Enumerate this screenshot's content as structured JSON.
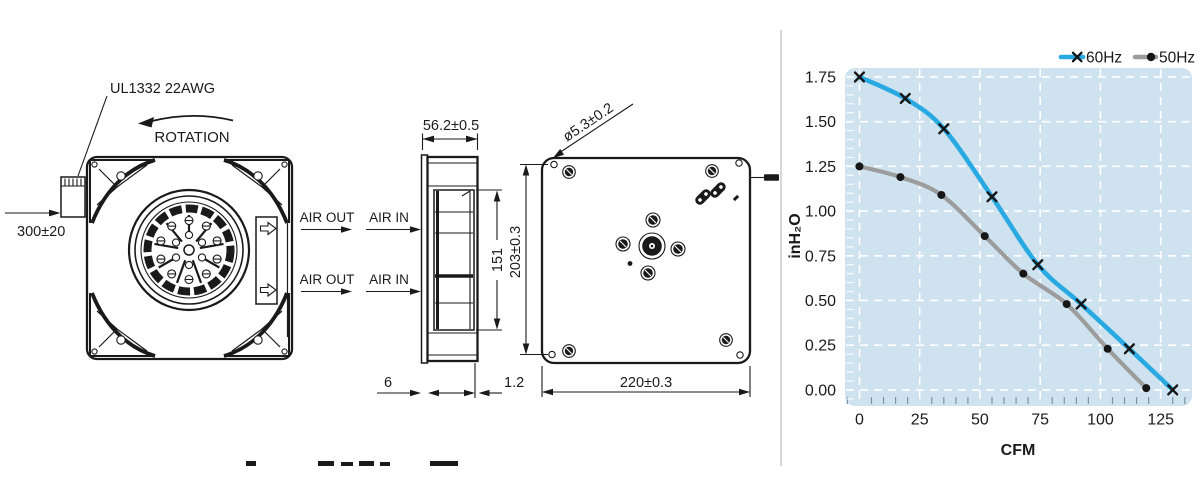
{
  "drawing": {
    "labels": {
      "wire_spec": "UL1332 22AWG",
      "rotation": "ROTATION",
      "wire_length": "300±20",
      "air_out": "AIR OUT",
      "air_in": "AIR IN",
      "side_width": "56.2±0.5",
      "impeller_height": "151",
      "mount_hole_pitch": "203±0.3",
      "body_width": "220±0.3",
      "hole_diameter": "ø5.3±0.2",
      "inlet_flange": "6",
      "plate_thickness": "1.2"
    }
  },
  "chart_data": {
    "type": "line",
    "title": "",
    "xlabel": "CFM",
    "ylabel": "inH₂O",
    "x_ticks": [
      0,
      25,
      50,
      75,
      100,
      125
    ],
    "x_tick_labels": [
      "0",
      "25",
      "50",
      "75",
      "100",
      "125"
    ],
    "y_ticks": [
      0,
      0.25,
      0.5,
      0.75,
      1.0,
      1.25,
      1.5,
      1.75
    ],
    "y_tick_labels": [
      "0.00",
      "0.25",
      "0.50",
      "0.75",
      "1.00",
      "1.25",
      "1.50",
      "1.75"
    ],
    "xlim": [
      -6,
      138
    ],
    "ylim": [
      -0.09,
      1.8
    ],
    "x_minor_step": 5,
    "y_minor_step": 0.05,
    "grid": "white-dashed",
    "plot_bg": "#cfe2f0",
    "legend_position": "top-right",
    "series": [
      {
        "name": "60Hz",
        "color": "#29a9e1",
        "marker": "x",
        "points": [
          [
            0,
            1.75
          ],
          [
            19,
            1.63
          ],
          [
            35,
            1.46
          ],
          [
            55,
            1.08
          ],
          [
            74,
            0.7
          ],
          [
            92,
            0.48
          ],
          [
            112,
            0.23
          ],
          [
            130,
            0.0
          ]
        ]
      },
      {
        "name": "50Hz",
        "color": "#9c9c9c",
        "marker": "dot",
        "points": [
          [
            0,
            1.25
          ],
          [
            17,
            1.19
          ],
          [
            34,
            1.09
          ],
          [
            52,
            0.86
          ],
          [
            68,
            0.65
          ],
          [
            86,
            0.48
          ],
          [
            103,
            0.23
          ],
          [
            119,
            0.01
          ]
        ]
      }
    ]
  }
}
